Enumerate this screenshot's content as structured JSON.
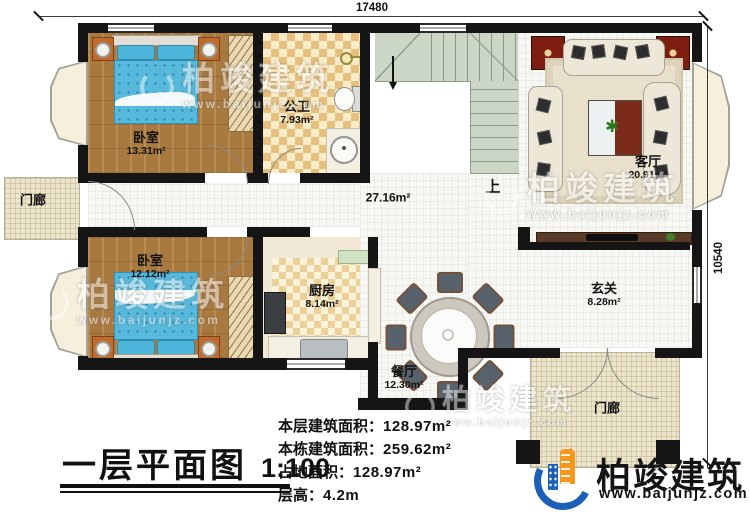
{
  "plan": {
    "dim_top": "17480",
    "dim_right": "10540",
    "hall_area": "27.16m²",
    "stairs_up": "上",
    "rooms": {
      "bedroom1": {
        "name": "卧室",
        "area": "13.31m²"
      },
      "bathroom": {
        "name": "公卫",
        "area": "7.93m²"
      },
      "porch_left": {
        "name": "门廊"
      },
      "bedroom2": {
        "name": "卧室",
        "area": "12.12m²"
      },
      "kitchen": {
        "name": "厨房",
        "area": "8.14m²"
      },
      "living": {
        "name": "客厅",
        "area": "20.91m²"
      },
      "foyer": {
        "name": "玄关",
        "area": "8.28m²"
      },
      "dining": {
        "name": "餐厅",
        "area": "12.30m²"
      },
      "porch_bottom": {
        "name": "门廊"
      }
    }
  },
  "title_block": {
    "title": "一层平面图",
    "scale": "1:100",
    "info": [
      {
        "label": "本层建筑面积：",
        "value": "128.97m²"
      },
      {
        "label": "本栋建筑面积：",
        "value": "259.62m²"
      },
      {
        "label": "占地面积：",
        "value": "128.97m²"
      },
      {
        "label": "层高：",
        "value": "4.2m"
      }
    ]
  },
  "branding": {
    "brand": "柏竣建筑",
    "url": "www.baijunjz.com"
  },
  "watermark": {
    "brand": "柏竣建筑",
    "url": "www.baijunjz.com"
  },
  "colors": {
    "wall": "#151515",
    "bed_blue": "#57badd",
    "stair_green": "#ccd6c6",
    "checker_tan": "#e7bf7d",
    "wood_floor": "#a97a40",
    "logo_blue": "#1c5fb6",
    "logo_orange": "#f5971d",
    "accent_dark_red": "#7c1d10"
  }
}
